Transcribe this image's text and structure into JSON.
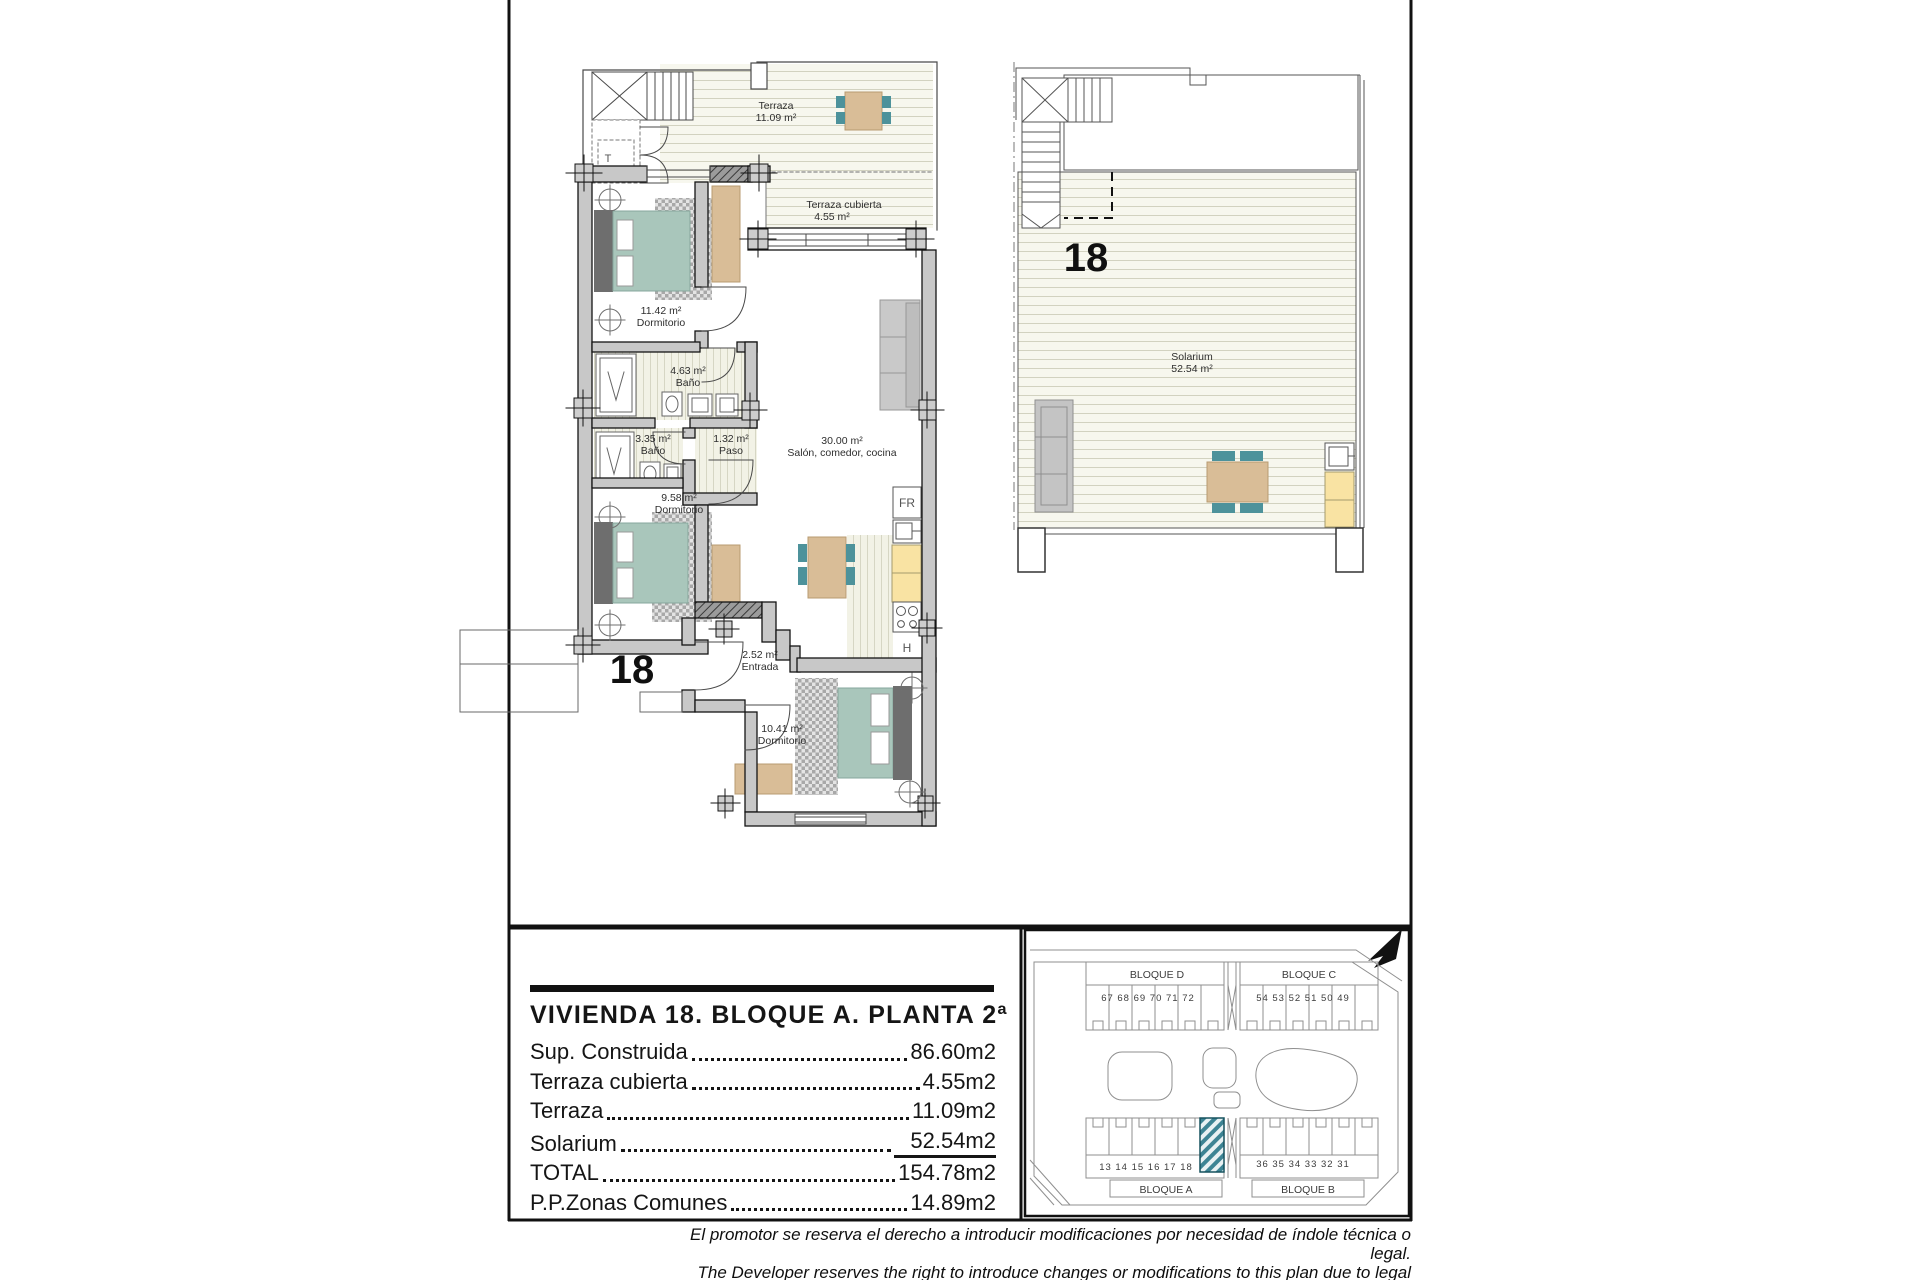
{
  "document": {
    "main_plan": {
      "unit_number": "18",
      "stair_label": "T",
      "rooms": {
        "terraza": {
          "name": "Terraza",
          "area": "11.09 m²"
        },
        "terraza_cubierta": {
          "name": "Terraza cubierta",
          "area": "4.55 m²"
        },
        "dormitorio_1": {
          "name": "Dormitorio",
          "area": "11.42 m²"
        },
        "bano_1": {
          "name": "Baño",
          "area": "4.63 m²"
        },
        "bano_2": {
          "name": "Baño",
          "area": "3.35 m²"
        },
        "paso": {
          "name": "Paso",
          "area": "1.32 m²"
        },
        "salon": {
          "name": "Salón, comedor, cocina",
          "area": "30.00 m²"
        },
        "dormitorio_2": {
          "name": "Dormitorio",
          "area": "9.58 m²"
        },
        "entrada": {
          "name": "Entrada",
          "area": "2.52 m²"
        },
        "dormitorio_3": {
          "name": "Dormitorio",
          "area": "10.41 m²"
        }
      },
      "kitchen": {
        "fridge": "FR",
        "hob": "H"
      }
    },
    "solarium_plan": {
      "unit_number": "18",
      "room": {
        "name": "Solarium",
        "area": "52.54 m²"
      }
    },
    "info_panel": {
      "title": "VIVIENDA 18. BLOQUE A. PLANTA 2ª",
      "rows": [
        {
          "label": "Sup. Construida",
          "value": "86.60m2"
        },
        {
          "label": "Terraza cubierta",
          "value": "4.55m2"
        },
        {
          "label": "Terraza",
          "value": "11.09m2"
        },
        {
          "label": "Solarium",
          "value": "52.54m2"
        },
        {
          "label": "TOTAL",
          "value": "154.78m2"
        },
        {
          "label": "P.P.Zonas Comunes",
          "value": "14.89m2"
        }
      ]
    },
    "site_plan": {
      "blocks": [
        {
          "label": "BLOQUE D",
          "units": "67  68  69  70  71 72"
        },
        {
          "label": "BLOQUE C",
          "units": "54 53  52  51  50  49"
        },
        {
          "label": "BLOQUE A",
          "units": "13  14  15  16  17 18"
        },
        {
          "label": "BLOQUE B",
          "units": "36 35  34  33  32  31"
        }
      ],
      "highlighted_unit": "18"
    },
    "disclaimer": {
      "es": "El promotor se reserva el derecho a introducir modificaciones por necesidad de índole técnica o legal.",
      "en": "The Developer reserves the right to introduce changes or modifications to this plan due to legal or technical reasons."
    },
    "colors": {
      "wall_gray": "#c8c8c8",
      "bed_green": "#a9c6bb",
      "chair_teal": "#4d929b",
      "wood_tan": "#d9bd97",
      "counter_yellow": "#f9e3a3",
      "highlight_hatch": "#3d8494"
    }
  }
}
